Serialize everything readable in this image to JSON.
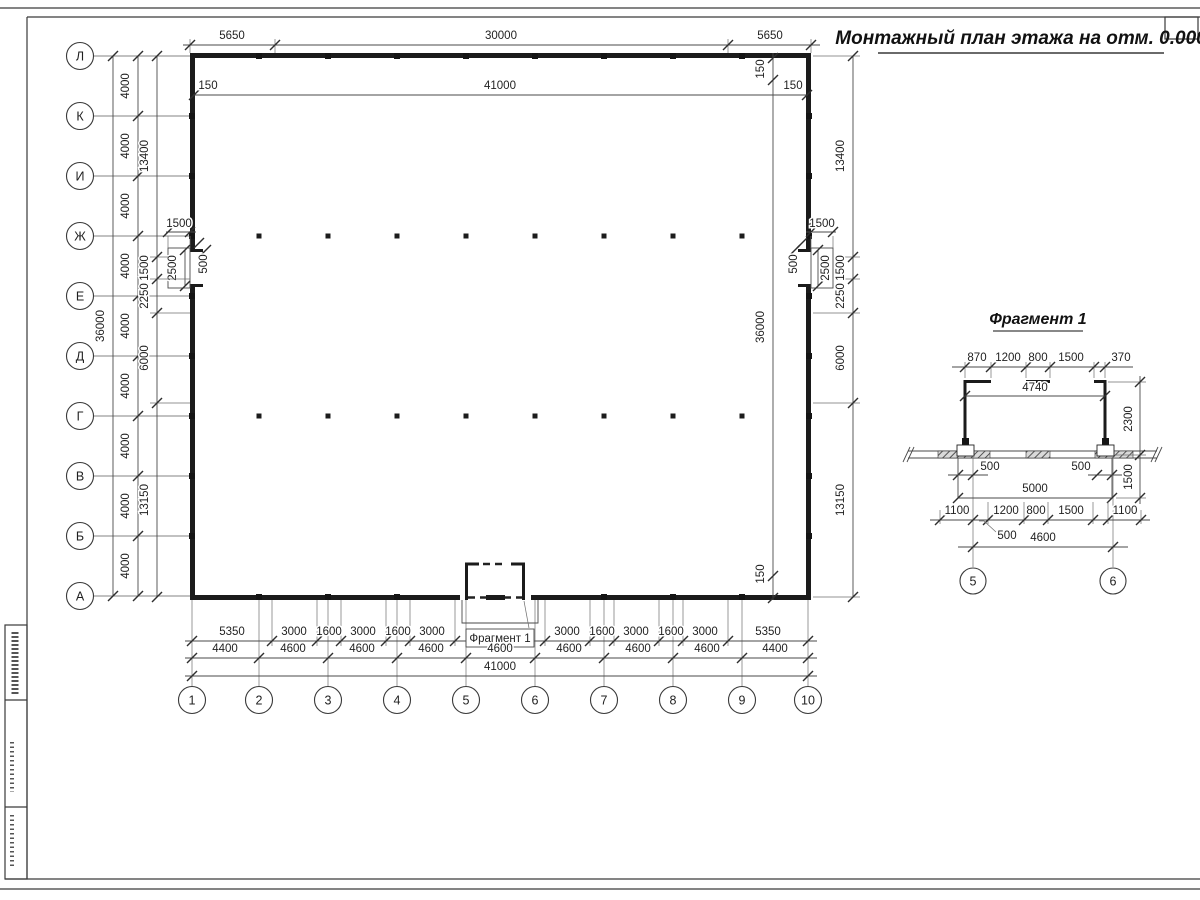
{
  "title": "Монтажный план этажа на отм. 0.000",
  "fragment_ref": "Фрагмент 1",
  "axes": {
    "rows": [
      "Л",
      "К",
      "И",
      "Ж",
      "Е",
      "Д",
      "Г",
      "В",
      "Б",
      "А"
    ],
    "cols": [
      "1",
      "2",
      "3",
      "4",
      "5",
      "6",
      "7",
      "8",
      "9",
      "10"
    ]
  },
  "dims": {
    "top_row1": [
      "5650",
      "30000",
      "5650"
    ],
    "top_row2": [
      "150",
      "41000",
      "150"
    ],
    "left_total": "36000",
    "left_bays": [
      "4000",
      "4000",
      "4000",
      "4000",
      "4000",
      "4000",
      "4000",
      "4000",
      "4000"
    ],
    "side_chain": [
      "13400",
      "1500",
      "2250",
      "6000",
      "13150"
    ],
    "right_inner": [
      "150",
      "36000",
      "150"
    ],
    "notch": {
      "w": "1500",
      "h": "2500",
      "ret": "500"
    },
    "bottom_row1_left": [
      "5350",
      "3000",
      "1600",
      "3000",
      "1600",
      "3000"
    ],
    "bottom_row1_right": [
      "3000",
      "1600",
      "3000",
      "1600",
      "3000",
      "5350"
    ],
    "bottom_row2": [
      "4400",
      "4600",
      "4600",
      "4600",
      "4600",
      "4600",
      "4600",
      "4600",
      "4400"
    ],
    "bottom_total": "41000"
  },
  "fragment": {
    "title": "Фрагмент 1",
    "top_chain": [
      "870",
      "1200",
      "800",
      "1500",
      "370"
    ],
    "inner_width": "4740",
    "height": "2300",
    "col_offset_left": "500",
    "col_offset_right": "500",
    "porch_width": "5000",
    "porch_depth": "1500",
    "bottom_chain": [
      "1100",
      "1200",
      "800",
      "1500",
      "1100"
    ],
    "bottom_small": "500",
    "axes_span": "4600",
    "axes": [
      "5",
      "6"
    ]
  }
}
